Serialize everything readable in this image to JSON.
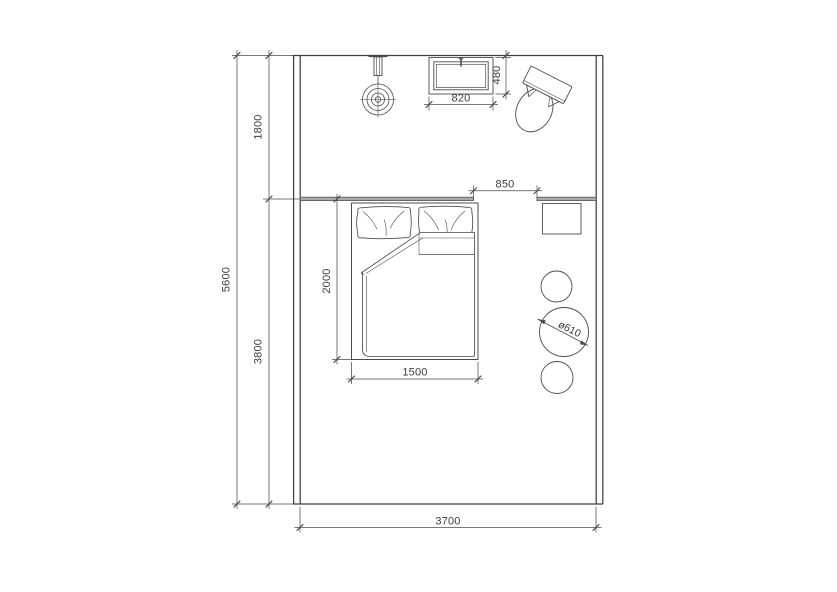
{
  "drawing": {
    "kind": "bedroom-and-bathroom floor plan",
    "colors": {
      "line": "#4b4b4b",
      "wall": "#3f3f3f",
      "text": "#3c3c3c",
      "partition_fill": "#a9a9a9",
      "background": "#ffffff"
    }
  },
  "dimensions": {
    "room_height_total": "5600",
    "bathroom_depth": "1800",
    "bedroom_depth": "3800",
    "room_width": "3700",
    "door_opening": "850",
    "bed_length": "2000",
    "bed_width": "1500",
    "basin_width": "820",
    "basin_depth": "480",
    "table_diameter": "ø610"
  },
  "fixtures": {
    "shower": "shower-head with wall valve",
    "basin": "rectangular wash basin with faucet",
    "toilet": "toilet (rotated in corner)",
    "bed": "double bed with two pillows and folded duvet",
    "nightstand": "square bedside table",
    "stools": "two round stools and one round table"
  }
}
